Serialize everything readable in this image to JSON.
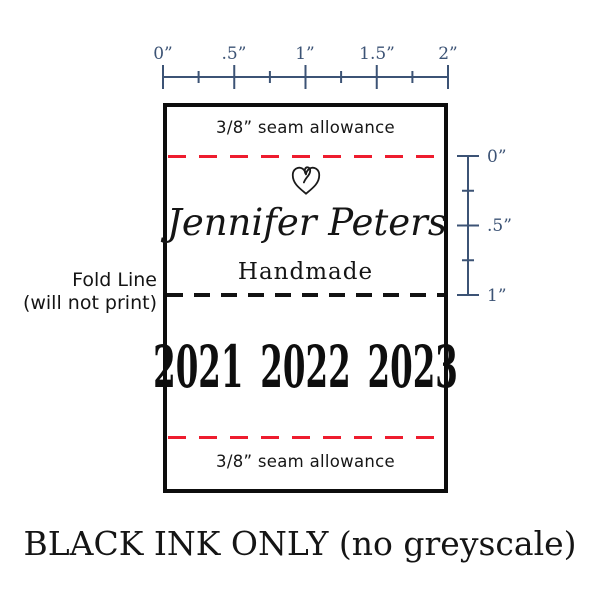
{
  "design": {
    "seam_top": "3/8” seam allowance",
    "name": "Jennifer Peters",
    "subtitle": "Handmade",
    "years": [
      "2021",
      "2022",
      "2023"
    ],
    "seam_bottom": "3/8” seam allowance"
  },
  "rulers": {
    "horizontal_ticks": [
      "0”",
      ".5”",
      "1”",
      "1.5”",
      "2”"
    ],
    "vertical_ticks": [
      "0”",
      ".5”",
      "1”"
    ]
  },
  "annotations": {
    "fold_line_1": "Fold Line",
    "fold_line_2": "(will not print)",
    "footer": "BLACK INK ONLY (no greyscale)"
  },
  "colors": {
    "accent_red": "#ee1c2e",
    "ruler_blue": "#3c5375",
    "ink_black": "#111111"
  }
}
